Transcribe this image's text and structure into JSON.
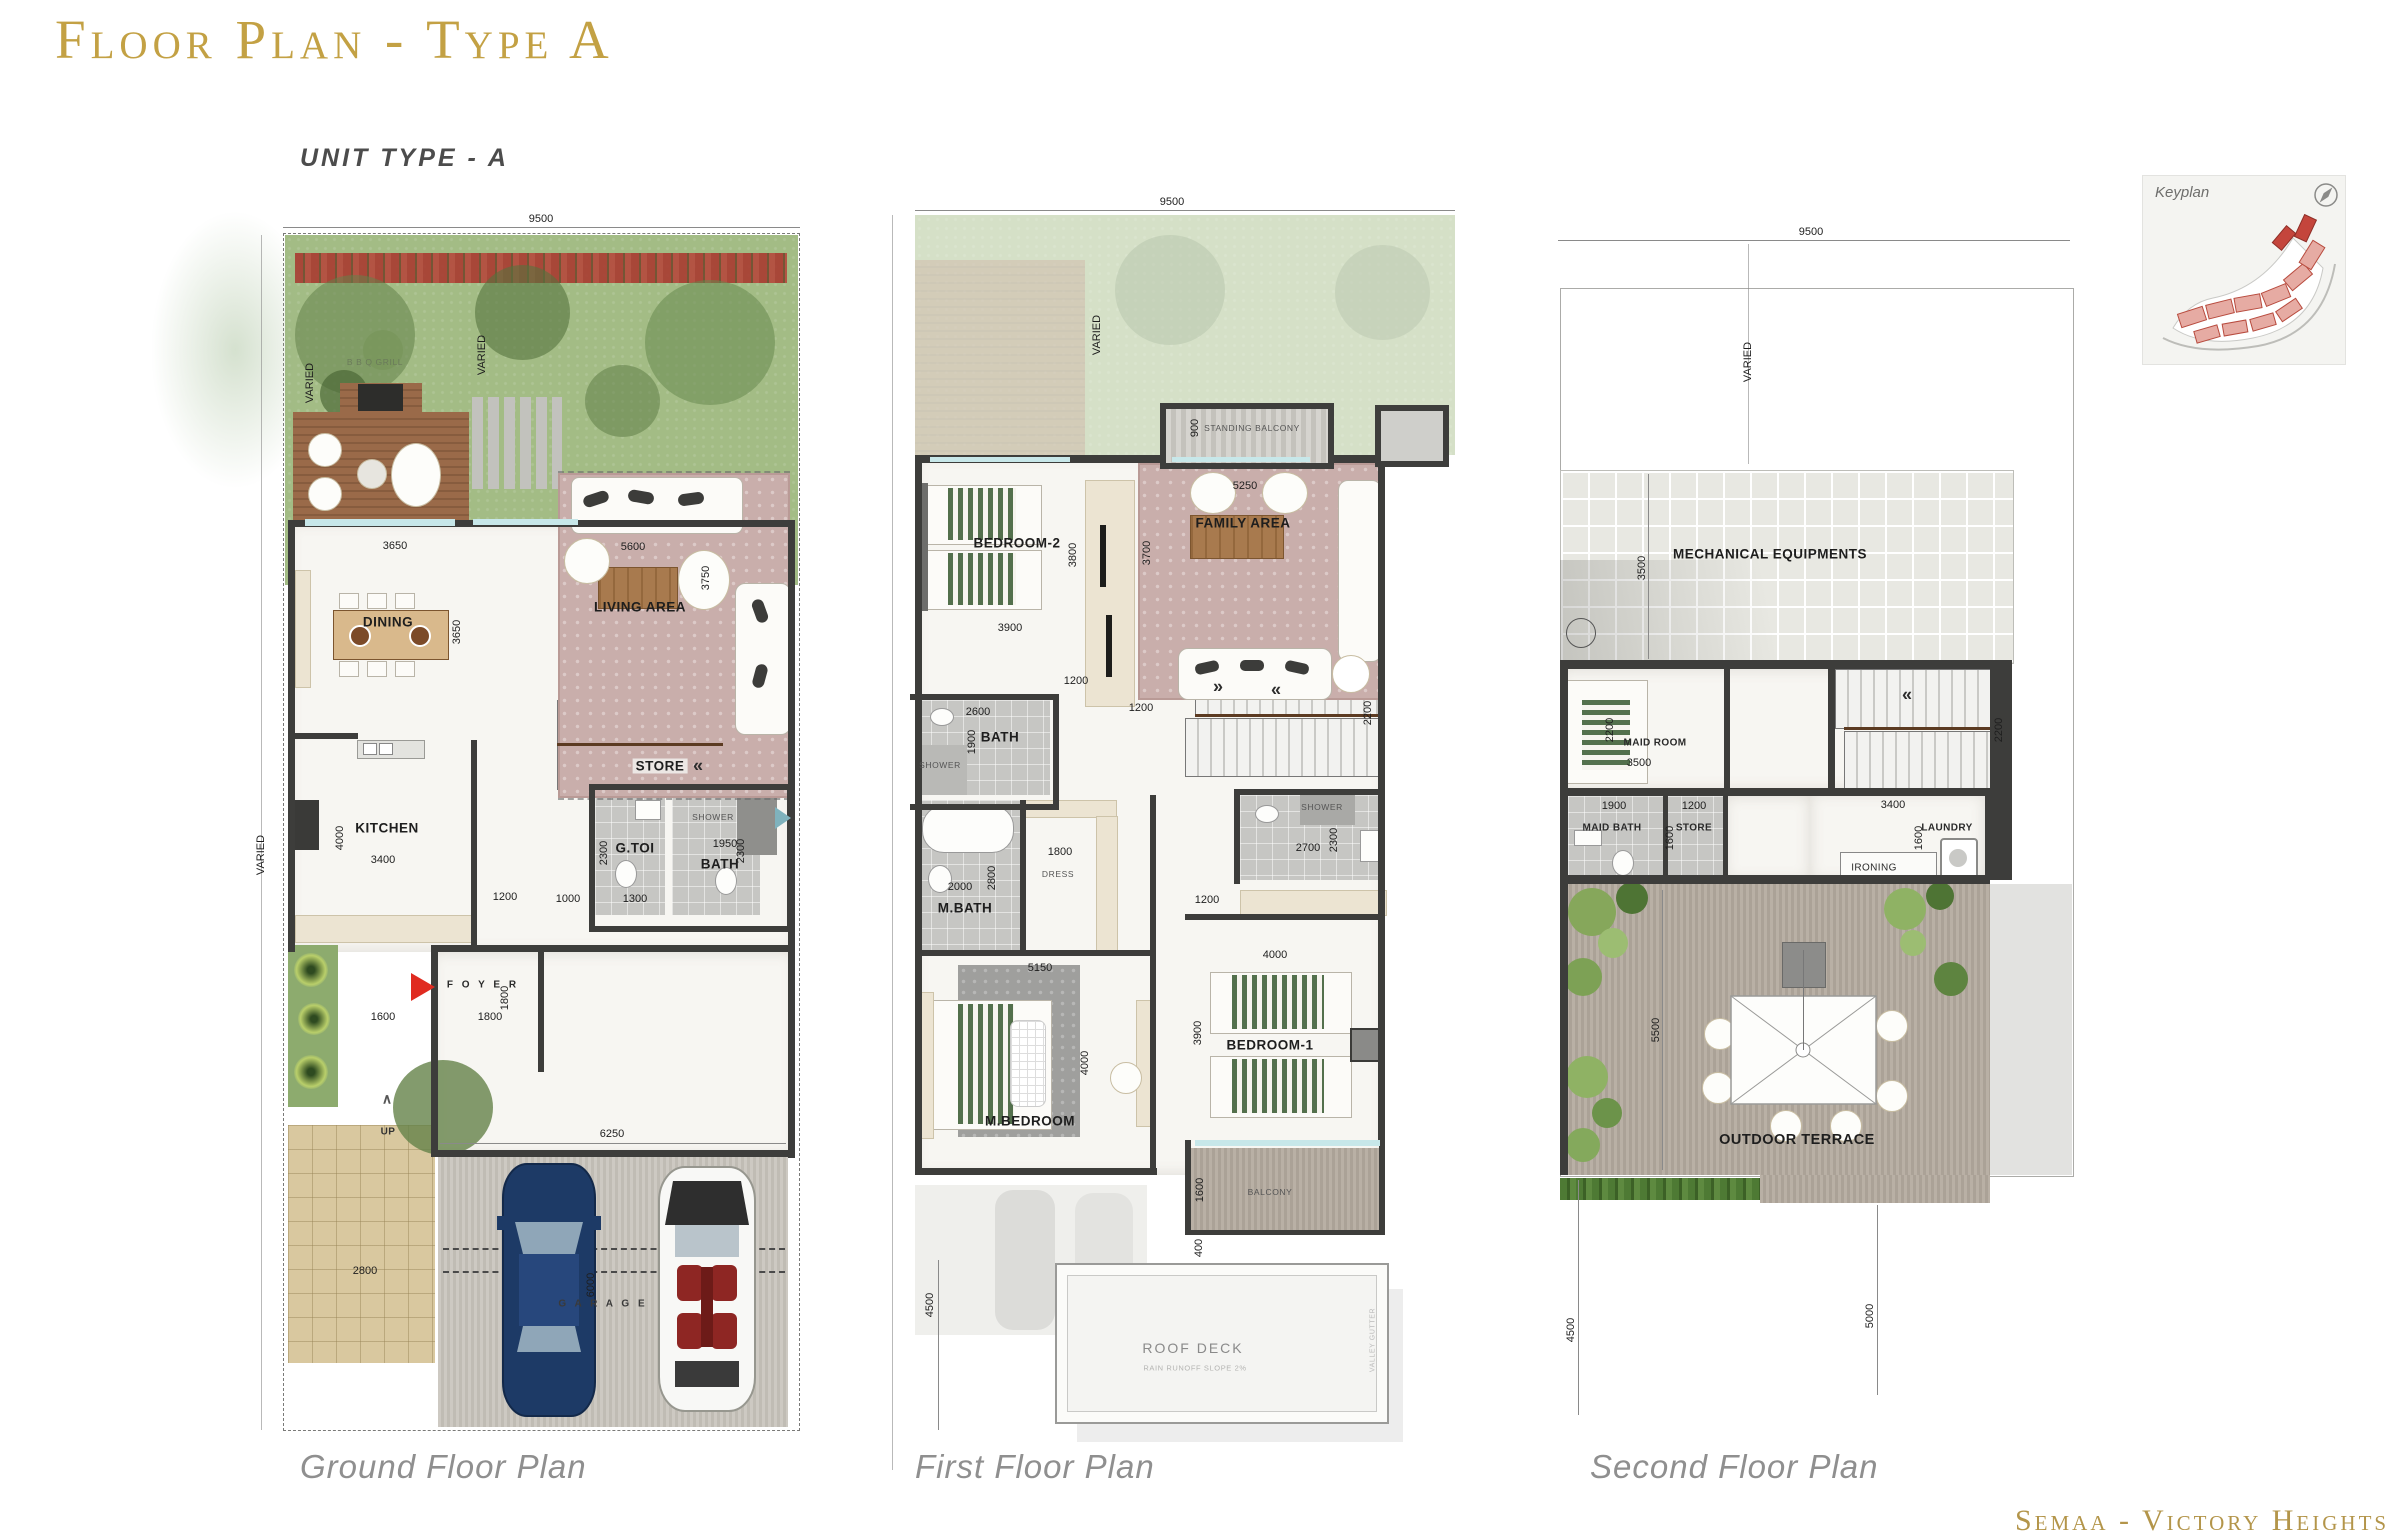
{
  "page": {
    "title": "Floor Plan - Type A",
    "unit_label": "UNIT TYPE - A",
    "watermark": "Semaa - Victory Heights"
  },
  "keyplan": {
    "label": "Keyplan"
  },
  "captions": {
    "ground": "Ground Floor Plan",
    "first": "First Floor Plan",
    "second": "Second Floor Plan"
  },
  "ground": {
    "rooms": {
      "bbq": "B B Q  GRILL",
      "dining": "DINING",
      "living": "LIVING AREA",
      "kitchen": "KITCHEN",
      "store": "STORE",
      "gtoi": "G.TOI",
      "bath": "BATH",
      "shower": "SHOWER",
      "foyer": "F O Y E R",
      "guest": "GUEST ROOM",
      "up": "UP",
      "garage": "G A R A G E"
    },
    "dims": {
      "lot_w": "9500",
      "varied_left": "VARIED",
      "varied_g1": "VARIED",
      "varied_g2": "VARIED",
      "deck_w": "3650",
      "dining_w": "3650",
      "living_w": "5600",
      "living_h": "3750",
      "kitchen_h": "4000",
      "kitchen_w": "3400",
      "hall_a": "1200",
      "hall_b": "1000",
      "gtoi_h": "2300",
      "gtoi_w": "1300",
      "bath_w": "1950",
      "bath_h": "2300",
      "court_w": "1600",
      "foyer_w": "1800",
      "foyer_h": "1800",
      "guest_w": "3800",
      "guest_h": "3500",
      "garage_w": "6250",
      "garage_h": "6000",
      "drive_w": "2800"
    }
  },
  "first": {
    "rooms": {
      "stbalcony": "STANDING BALCONY",
      "bed2": "BEDROOM-2",
      "family": "FAMILY AREA",
      "bath": "BATH",
      "shower": "SHOWER",
      "mbath": "M.BATH",
      "dress": "DRESS",
      "shower2": "SHOWER",
      "mbed": "M.BEDROOM",
      "bed1": "BEDROOM-1",
      "balcony": "BALCONY",
      "roofdeck": "ROOF DECK",
      "roofnote": "RAIN RUNOFF SLOPE 2%",
      "gutter": "VALLEY GUTTER"
    },
    "dims": {
      "lot_w": "9500",
      "varied": "VARIED",
      "stb_d": "900",
      "family_w": "5250",
      "family_h": "3700",
      "bed2_h": "3800",
      "bed2_w": "3900",
      "hall_a": "1200",
      "hall_b": "1200",
      "stair_h": "2200",
      "bath_w": "2600",
      "bath_h": "1900",
      "mbath_w": "2000",
      "mbath_h": "2800",
      "dress_w": "1800",
      "sh_w": "2700",
      "sh_h": "2300",
      "hall_c": "1200",
      "bed1_w": "4000",
      "mbed_w": "5150",
      "mbed_h": "4000",
      "bed1_h": "3900",
      "balc_h": "1600",
      "balc_off": "400",
      "side": "4500"
    }
  },
  "second": {
    "rooms": {
      "mech": "MECHANICAL EQUIPMENTS",
      "maid": "MAID ROOM",
      "maidbath": "MAID BATH",
      "store": "STORE",
      "laundry": "LAUNDRY",
      "ironing": "IRONING",
      "terrace": "OUTDOOR TERRACE"
    },
    "dims": {
      "lot_w": "9500",
      "varied": "VARIED",
      "mech_h": "3500",
      "maid_h": "2200",
      "maid_w": "3500",
      "stair_h": "2200",
      "maidbath_w": "1900",
      "store_w": "1200",
      "store_h": "1600",
      "laundry_w": "3400",
      "laundry_h": "1600",
      "terrace_h": "5500",
      "side_a": "4500",
      "side_b": "5000"
    }
  }
}
